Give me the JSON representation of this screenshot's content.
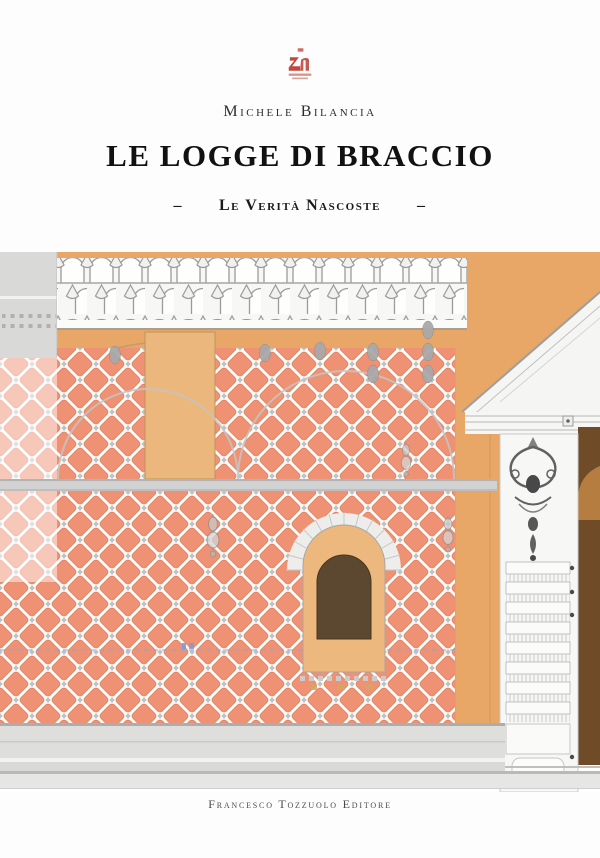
{
  "cover": {
    "author": "Michele Bilancia",
    "title": "LE LOGGE DI BRACCIO",
    "subtitle": "Le Verità Nascoste",
    "subtitle_dash": "–",
    "publisher": "Francesco Tozzuolo Editore"
  },
  "colors": {
    "wall_orange": "#E8A766",
    "diamond_salmon": "#EF9173",
    "diamond_outline": "#DE7E5E",
    "panel_tan": "#ECB77C",
    "window_frame_tan": "#EDB87D",
    "window_dark_brown": "#5C4730",
    "side_dark_brown": "#6F4C27",
    "side_arch_brown": "#B67D40",
    "stone_grey": "#D2D2D2",
    "grey_block": "#D9D9D8",
    "logo_red": "#C2473E",
    "annotation_blue": "#8FA6DF",
    "text_black": "#1A1A1A"
  }
}
